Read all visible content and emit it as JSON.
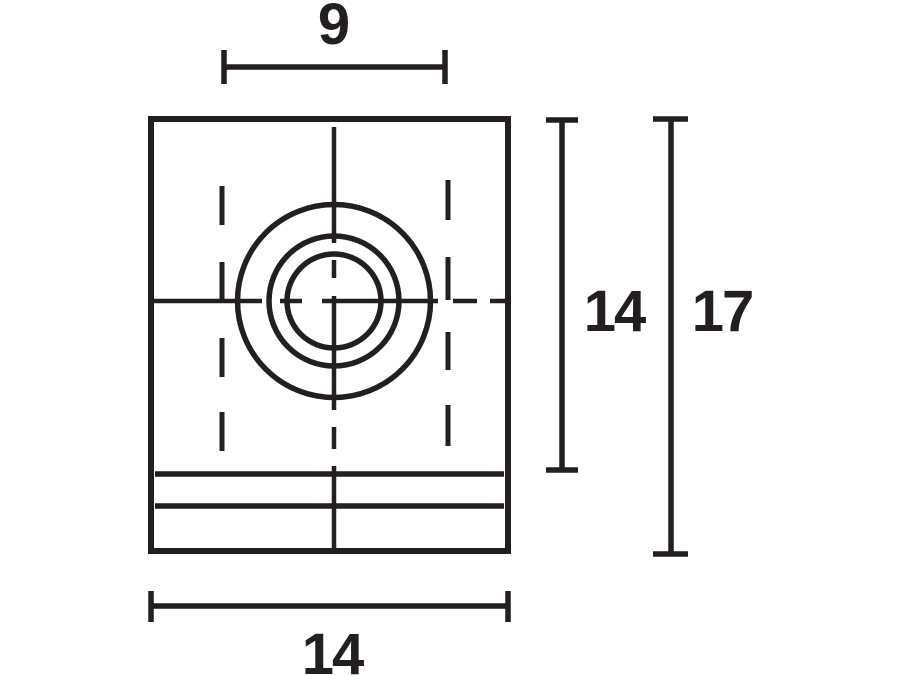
{
  "drawing": {
    "kind": "technical-dimension-drawing",
    "view": "front view of mounting block with concentric hole",
    "line_color": "#231f20",
    "background_color": "#ffffff",
    "dimensions": {
      "hole_spacing_width": "9",
      "body_height": "14",
      "overall_height": "17",
      "overall_width": "14"
    }
  }
}
